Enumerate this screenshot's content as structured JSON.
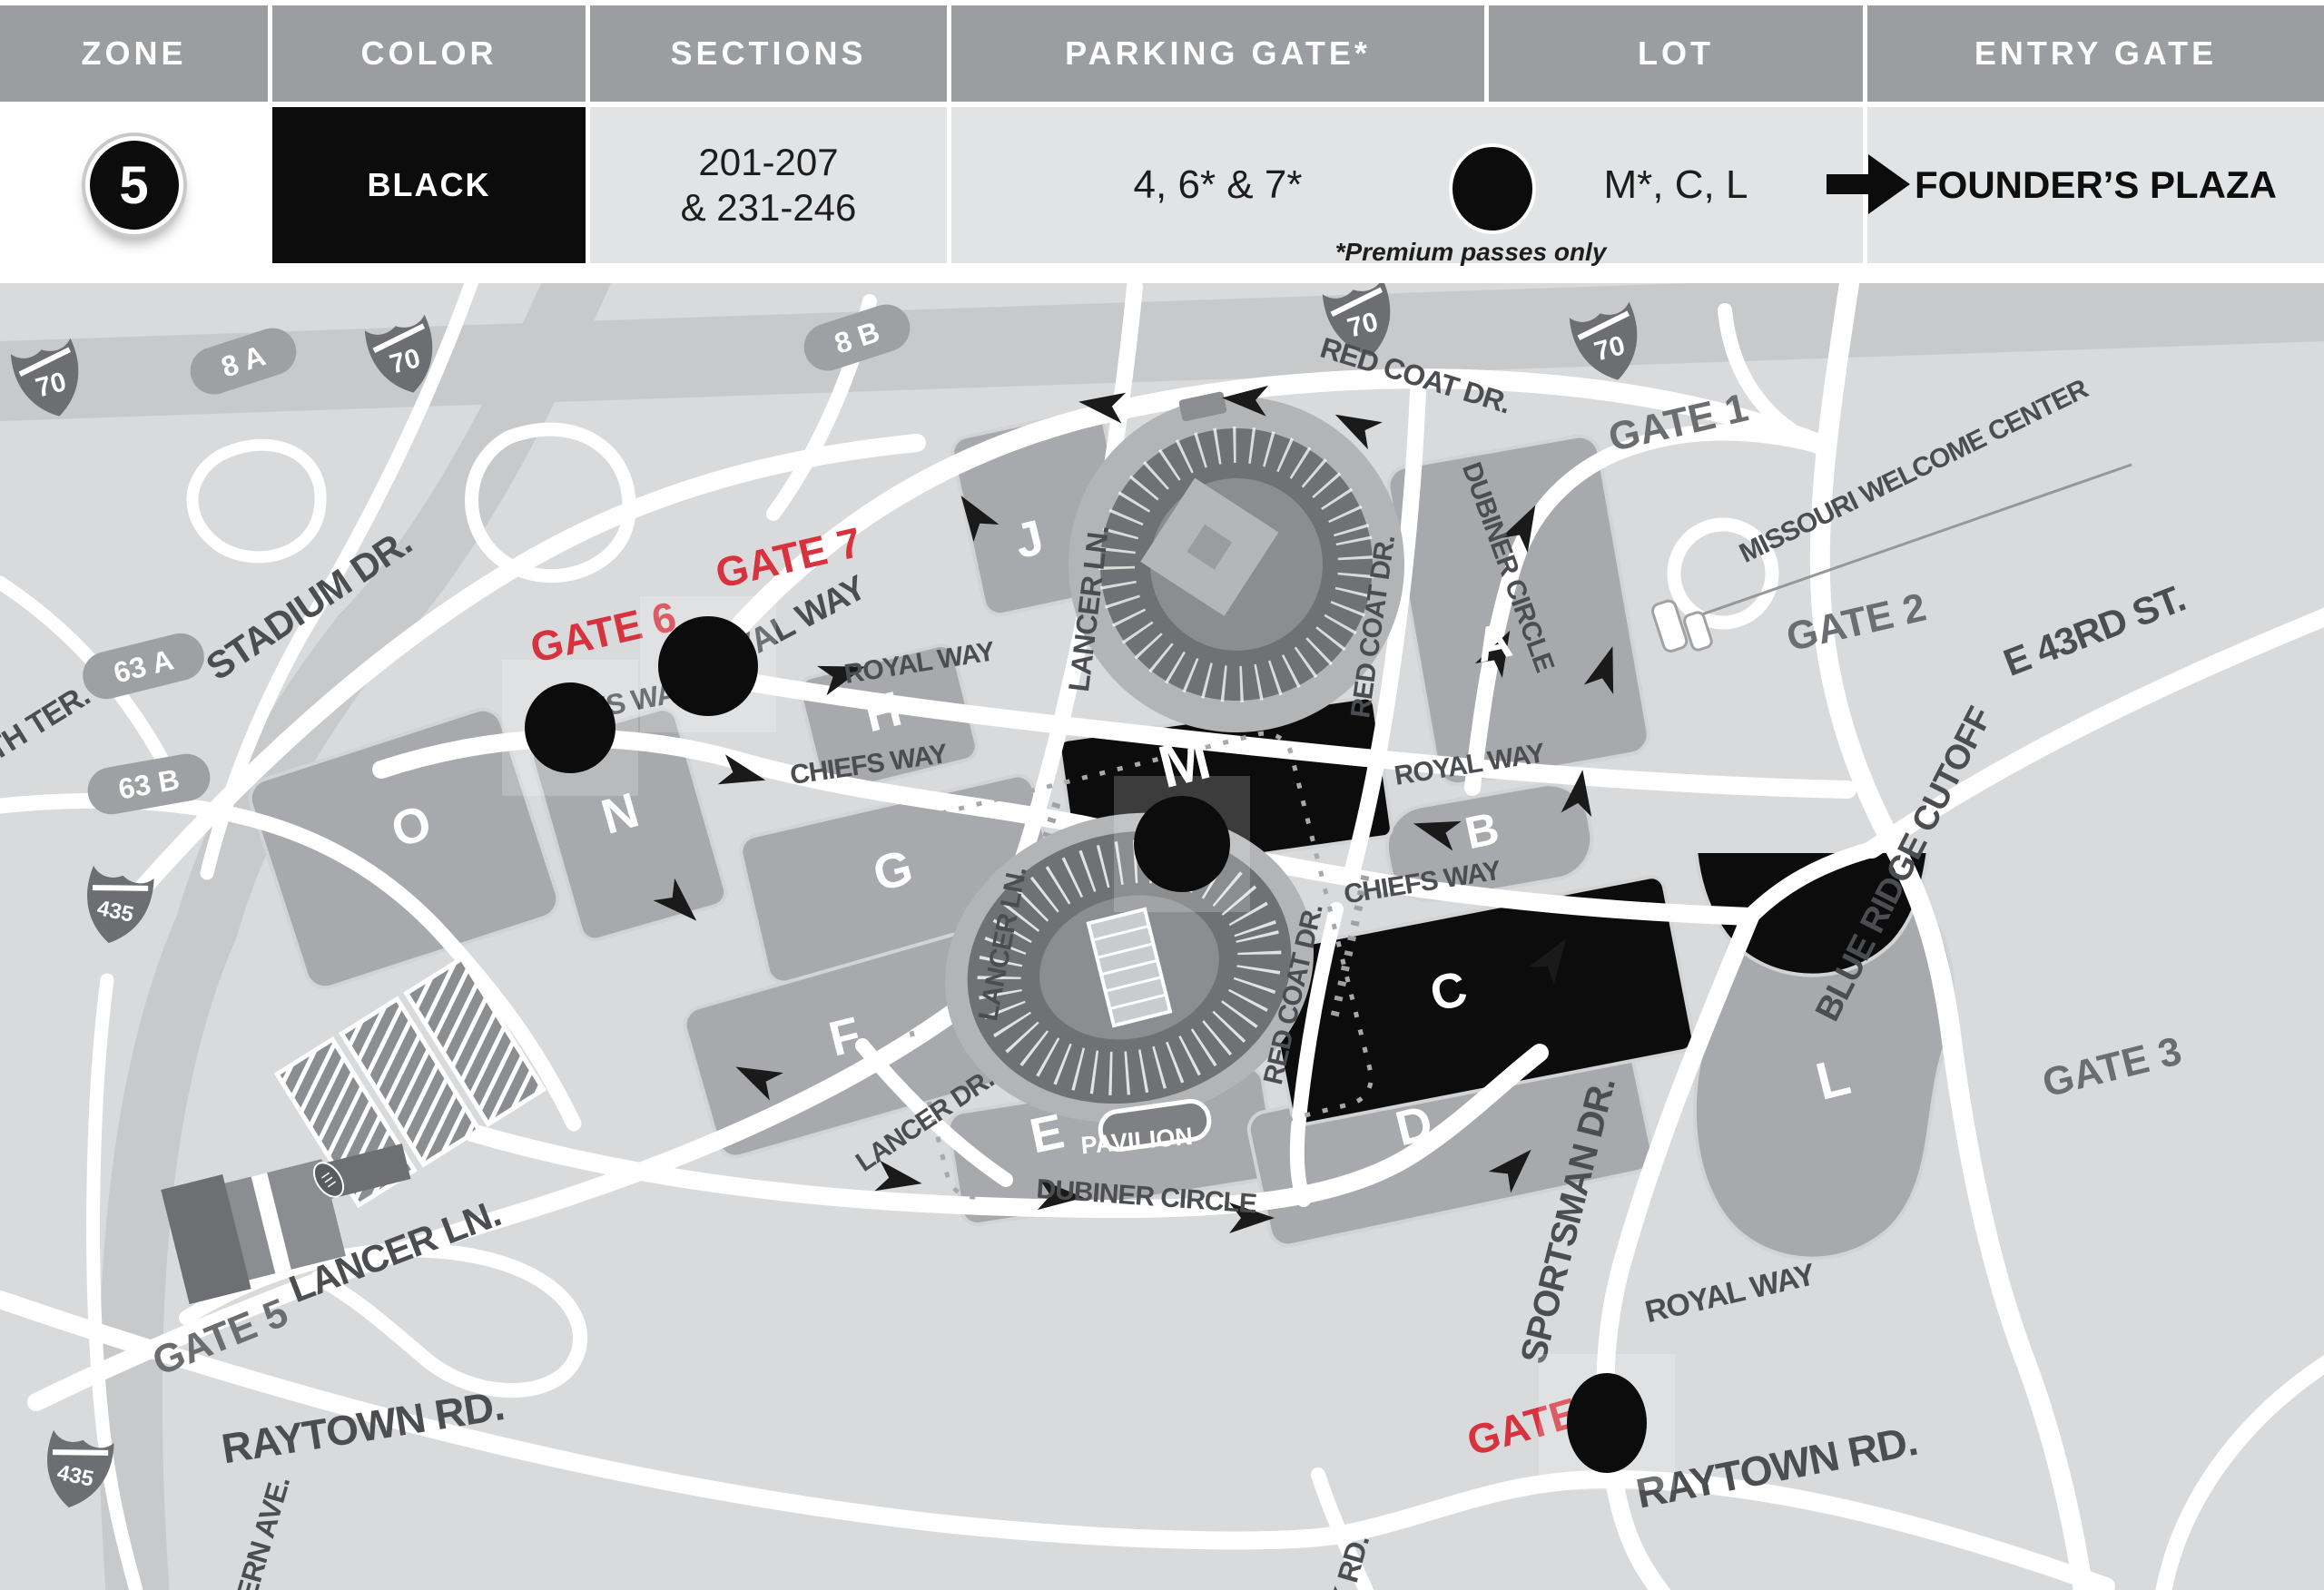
{
  "header": {
    "columns": [
      "ZONE",
      "COLOR",
      "SECTIONS",
      "PARKING GATE*",
      "LOT",
      "ENTRY GATE"
    ],
    "zone": {
      "number": "5"
    },
    "color": "BLACK",
    "sections": [
      "201-207",
      "& 231-246"
    ],
    "parking_gate": "4, 6* & 7*",
    "lot": "M*, C, L",
    "entry_gate": "FOUNDER’S PLAZA",
    "footnote": "*Premium passes only"
  },
  "map": {
    "gate_labels": {
      "gate1": "GATE 1",
      "gate2": "GATE 2",
      "gate3": "GATE 3",
      "gate4": "GATE 4",
      "gate5": "GATE 5",
      "gate6": "GATE 6",
      "gate7": "GATE 7"
    },
    "road_labels": {
      "stadium_dr": "STADIUM DR.",
      "chiefs_way": "CHIEFS WAY",
      "royal_way": "ROYAL WAY",
      "lancer_ln": "LANCER LN.",
      "lancer_dr": "LANCER DR.",
      "red_coat_dr": "RED COAT DR.",
      "dubiner_circle": "DUBINER CIRCLE",
      "sportsman_dr": "SPORTSMAN DR.",
      "blue_ridge_cutoff": "BLUE RIDGE CUTOFF",
      "e_43rd_st": "E 43RD ST.",
      "raytown_rd": "RAYTOWN RD.",
      "th_ter": "TH TER.",
      "ern_ave": "ERN AVE.",
      "k_rd": "K RD."
    },
    "poi_labels": {
      "missouri_welcome_center": "MISSOURI WELCOME CENTER",
      "pavilion": "PAVILION"
    },
    "lot_labels": {
      "a": "A",
      "b": "B",
      "c": "C",
      "d": "D",
      "e": "E",
      "f": "F",
      "g": "G",
      "h": "H",
      "j": "J",
      "l": "L",
      "m": "M",
      "n": "N",
      "o": "O"
    },
    "highway_shields": {
      "i70": "70",
      "i435": "435"
    },
    "exit_badges": {
      "x8a": "8 A",
      "x8b": "8 B",
      "x63a": "63 A",
      "x63b": "63 B"
    }
  },
  "colors": {
    "zone_black": "#0c0c0c",
    "gate_red": "#d6333e",
    "header_gray": "#9b9da0",
    "row_gray": "#e2e3e4",
    "map_bg": "#d9dadb",
    "lot_gray": "#a7a9ac",
    "label_gray": "#4b4d50"
  }
}
